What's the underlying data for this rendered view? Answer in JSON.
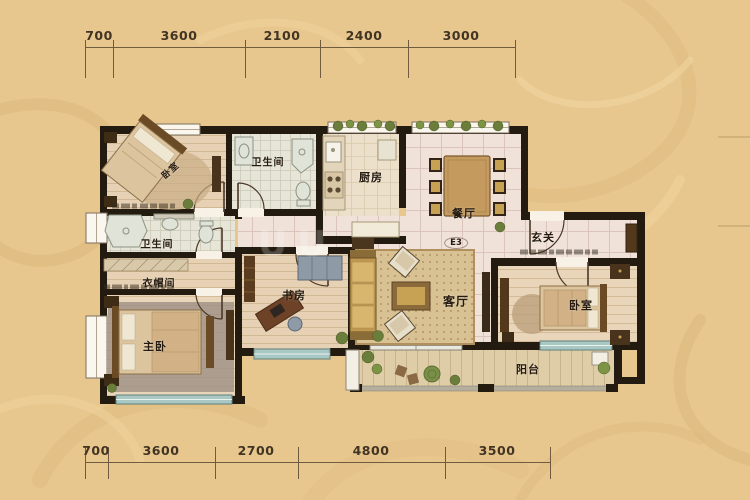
{
  "dimensions": {
    "top": [
      "700",
      "3600",
      "2100",
      "2400",
      "3000"
    ],
    "bottom": [
      "700",
      "3600",
      "2700",
      "4800",
      "3500"
    ]
  },
  "rooms": {
    "bedroom_top": "卧室",
    "bath_top": "卫生间",
    "kitchen": "厨房",
    "dining": "餐厅",
    "foyer": "玄关",
    "bath_lower": "卫生间",
    "closet": "衣帽间",
    "master_bedroom": "主卧",
    "study": "书房",
    "living_room": "客厅",
    "bedroom_right": "卧室",
    "balcony": "阳台"
  },
  "annotations": {
    "unit_code": "E3"
  },
  "watermark": "UU",
  "colors": {
    "background": "#e8c78e",
    "wall": "#241b10",
    "tile_floor": "#f0e2d9",
    "wood_floor": "#e6d1b5",
    "window_glass": "#a9c8c4",
    "dimension_text": "#413423"
  }
}
